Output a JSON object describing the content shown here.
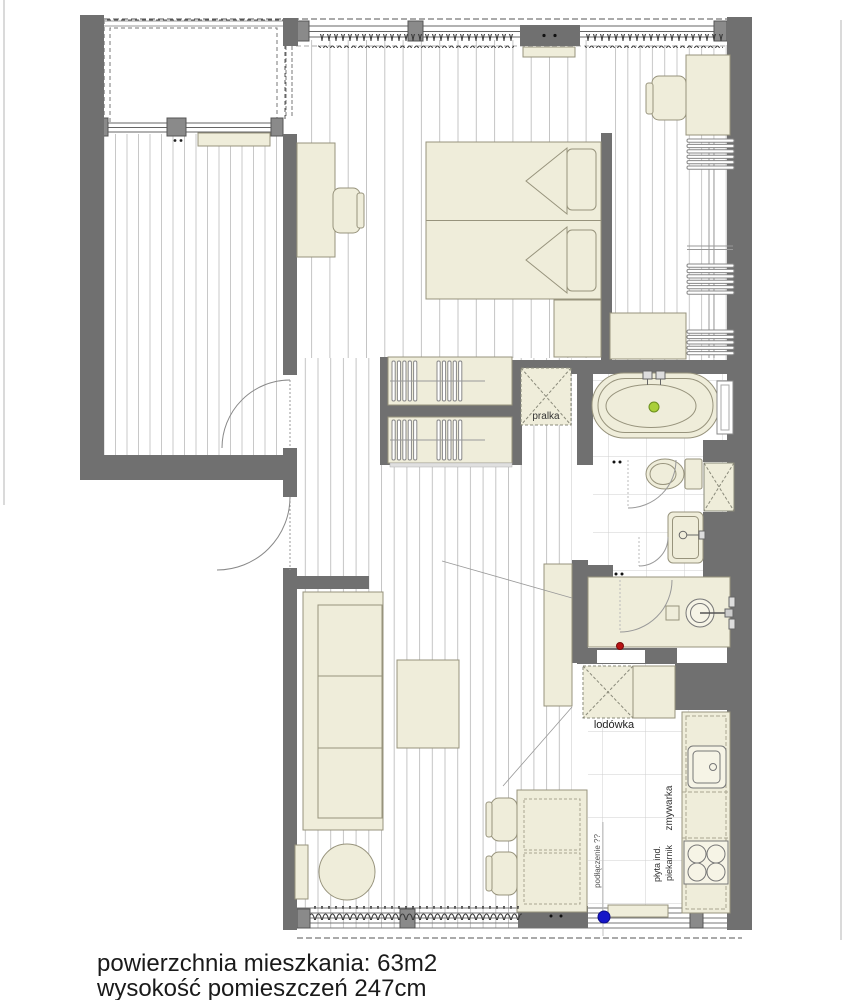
{
  "plan": {
    "labels": {
      "washing_machine": "pralka",
      "fridge": "lodówka",
      "dishwasher": "zmywarka",
      "induction_hob": "płyta ind.",
      "oven": "piekarnik",
      "connection": "podłączenie ??"
    },
    "footer": {
      "line1": "powierzchnia mieszkania: 63m2",
      "line2": "wysokość pomieszczeń 247cm"
    },
    "colors": {
      "wall": "#707070",
      "furniture_fill": "#efedda",
      "furniture_stroke": "#97937c",
      "floor_line": "#c6c6c6",
      "tile_line": "#cfcfcf",
      "drain_dot": "#a9cf39",
      "connection_dot": "#1616c8",
      "alert_dot": "#b81414",
      "background": "#ffffff",
      "text": "#1a1a1a"
    }
  }
}
